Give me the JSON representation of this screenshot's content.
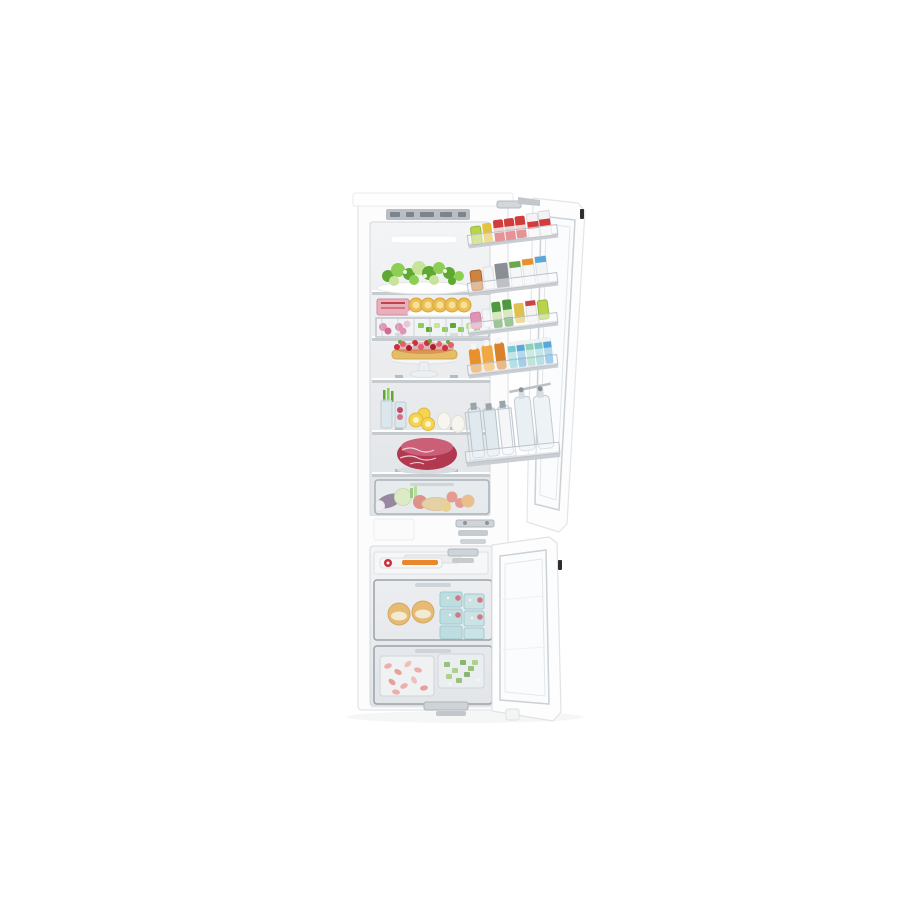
{
  "scene": {
    "kind": "product-photo",
    "subject": "built-in fridge freezer, both doors open, fully stocked",
    "background_color": "#ffffff"
  },
  "colors": {
    "background": "#ffffff",
    "cabinet_white": "#fcfcfd",
    "cabinet_edge": "#e6e8ea",
    "interior_top": "#f3f4f6",
    "interior_bottom": "#e1e4e7",
    "shelf_edge": "#c6cbd0",
    "panel_gray": "#b9bec4",
    "panel_segment": "#7e848b",
    "leaf_green": "#5fa832",
    "leaf_green_light": "#8fce55",
    "leaf_green_pale": "#c8e49a",
    "berry_red": "#c7333f",
    "berry_red_light": "#e4606a",
    "tart_crust": "#e5bd66",
    "pastry_yellow": "#ecbf52",
    "pastry_center": "#f7e09c",
    "meat_pink": "#e8b0bb",
    "beef_red": "#b23850",
    "beef_red_light": "#cb5f78",
    "radish_pink": "#e292b4",
    "lemon_yellow": "#f5d54e",
    "egg_white": "#f7f5f0",
    "eggplant_purple": "#53305e",
    "pepper_red": "#d2452e",
    "bread_tan": "#e2b466",
    "orange_fruit": "#e8973a",
    "cabbage_green": "#cfe6a0",
    "can_red": "#d23c3c",
    "can_yellow": "#e3c23c",
    "lime_green": "#b7d44a",
    "carton_green": "#6aa84a",
    "juice_orange": "#e8912c",
    "bottle_teal": "#7ac8d0",
    "bottle_blue": "#5aa8d8",
    "bottle_mint": "#8fd0b8",
    "glass_tint": "#dfe9ee",
    "milk_white": "#f4f6f8",
    "tub_yellow": "#e8a430",
    "frozen_teal": "#a8d8dc",
    "shrimp_pink": "#ef9287",
    "frozen_green": "#6fae3e",
    "metal_gray": "#c9ced3",
    "vent_black": "#2e2e30"
  },
  "fridge": {
    "control_panel": {
      "style": "recessed touch display with dark segments"
    },
    "shelves": [
      {
        "name": "top-shelf",
        "items": [
          "leafy greens and broccoli on white platter"
        ]
      },
      {
        "name": "second-shelf",
        "items": [
          "packaged meat",
          "round egg tarts on tray"
        ]
      },
      {
        "name": "wire-basket",
        "items": [
          "radishes",
          "chopped greens"
        ]
      },
      {
        "name": "middle-shelf",
        "items": [
          "berry tart on white cake stand"
        ]
      },
      {
        "name": "fourth-shelf",
        "items": [
          "vegetable sticks in glasses",
          "lemon slices",
          "two eggs"
        ]
      },
      {
        "name": "fifth-shelf",
        "items": [
          "raw beef roast"
        ]
      },
      {
        "name": "crisper-drawer",
        "items": [
          "eggplant",
          "cabbage",
          "red pepper",
          "tomatoes",
          "baguette",
          "orange"
        ]
      }
    ],
    "door_bins": [
      {
        "name": "bin-1",
        "items": [
          "lime pack",
          "yellow can",
          "red cans",
          "red-label cartons"
        ]
      },
      {
        "name": "bin-2",
        "items": [
          "amber jar",
          "white jar",
          "gray box",
          "cartons with colored caps"
        ]
      },
      {
        "name": "bin-3",
        "items": [
          "pink jar",
          "white tube",
          "green bottles",
          "yellow jar",
          "red-lid jar"
        ]
      },
      {
        "name": "bin-4",
        "items": [
          "orange juice bottles",
          "teal and blue beverage bottles"
        ]
      },
      {
        "name": "bin-5",
        "items": [
          "glass bottles in wire rack",
          "hanging swing-top bottles"
        ]
      }
    ]
  },
  "freezer": {
    "top_shelf": {
      "items": [
        "flat frozen packs with orange stripe and red seal"
      ]
    },
    "drawers": [
      {
        "name": "upper-drawer",
        "items": [
          "two yellow tubs",
          "stacked teal frozen-meal boxes"
        ]
      },
      {
        "name": "lower-drawer",
        "items": [
          "tray of frozen shrimp",
          "tray of frozen chopped greens"
        ]
      }
    ]
  }
}
